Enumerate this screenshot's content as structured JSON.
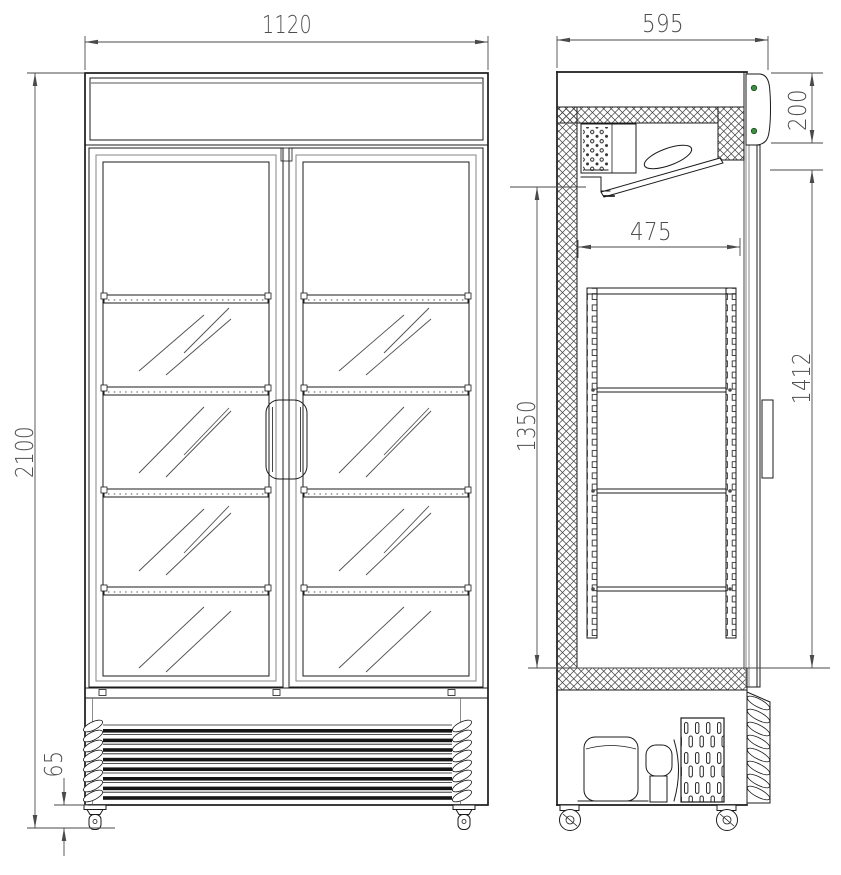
{
  "drawing": {
    "dims": {
      "width": "1120",
      "depth": "595",
      "height": "2100",
      "header_height": "200",
      "interior_depth": "475",
      "interior_height": "1350",
      "door_height": "1412",
      "caster_height": "65"
    },
    "colors": {
      "line": "#1b1b1b",
      "dim": "#4a4a4a",
      "led_green": "#3b9143",
      "background": "#ffffff"
    }
  }
}
